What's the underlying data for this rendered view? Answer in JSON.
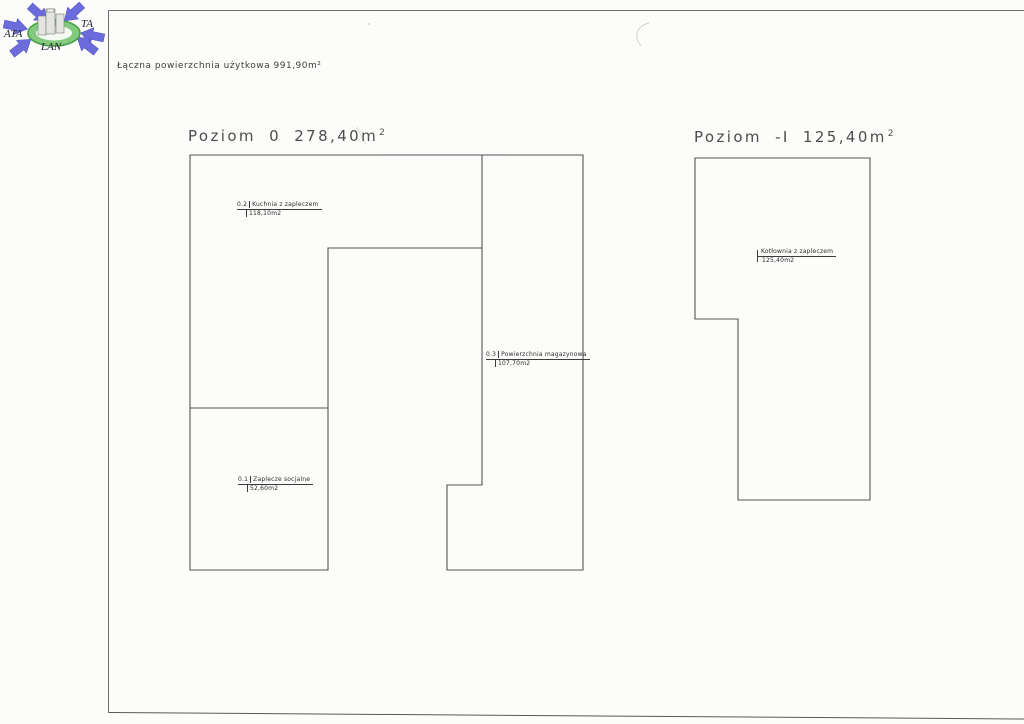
{
  "page": {
    "header": "Łączna powierzchnia użytkowa 991,90m²"
  },
  "logo": {
    "text_left": "ATA",
    "text_right": "TA",
    "text_bottom": "LAN",
    "arrow_color": "#6b6bdb",
    "ellipse_color": "#84ca7e",
    "ellipse_edge_color": "#46a046",
    "building_color": "#e4e4e1"
  },
  "plans": [
    {
      "title": "Poziom 0 278,40m",
      "title_sup": "2",
      "rooms": [
        {
          "number": "0.2",
          "name": "Kuchnia z zapleczem",
          "area": "118,10m2"
        },
        {
          "number": "0.3",
          "name": "Powierzchnia magazynowa",
          "area": "107,70m2"
        },
        {
          "number": "0.1",
          "name": "Zaplecze socjalne",
          "area": "52,60m2"
        }
      ]
    },
    {
      "title": "Poziom -I 125,40m",
      "title_sup": "2",
      "rooms": [
        {
          "name": "Kotłownia z zapleczem",
          "area": "125,40m2"
        }
      ]
    }
  ]
}
